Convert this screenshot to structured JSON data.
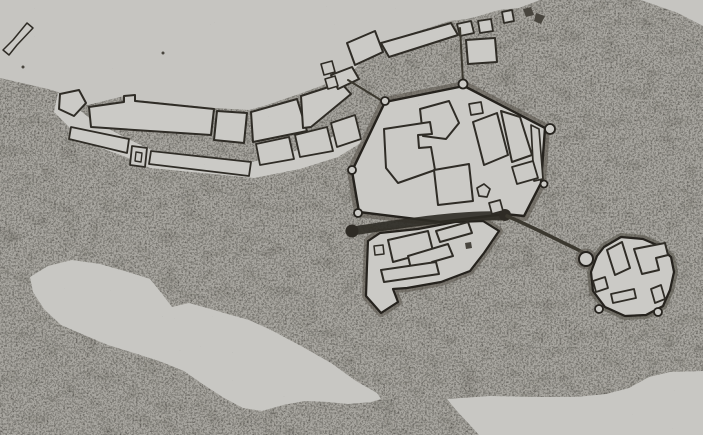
{
  "canvas": {
    "width": 703,
    "height": 435
  },
  "palette": {
    "water": "#c6c5c1",
    "lake": "#c8c7c3",
    "platform": "#cbcac6",
    "landBase": "#a7a59f",
    "ink": "#2e2b25",
    "inkSoft": "#48453e",
    "outline": "#2f2c26",
    "wall": "#25221d",
    "fringe": "#5b574f",
    "road": "#3b382f"
  },
  "map": {
    "layers": [
      {
        "shape": "rect",
        "name": "water-background",
        "x": 0,
        "y": 0,
        "w": 703,
        "h": 435,
        "fill": "water"
      },
      {
        "shape": "path",
        "name": "land-mass",
        "fill": "landBase",
        "filter": "stipple",
        "d": "M0,78 L48,89 58,92 88,105 124,96 136,100 214,108 249,110 264,106 302,93 334,81 354,70 363,60 381,43 450,21 467,19 479,16 499,10 519,8 540,0 L703,0 L703,435 L0,435 Z"
      },
      {
        "shape": "polygon",
        "name": "islet-a",
        "points": "523,9 531,7 534,15 526,17",
        "fill": "inkSoft"
      },
      {
        "shape": "polygon",
        "name": "islet-b",
        "points": "536,13 545,16 541,24 534,21",
        "fill": "inkSoft"
      },
      {
        "shape": "circle",
        "name": "water-dot-a",
        "cx": 163,
        "cy": 53,
        "r": 1.5,
        "fill": "inkSoft"
      },
      {
        "shape": "circle",
        "name": "water-dot-b",
        "cx": 23,
        "cy": 67,
        "r": 1.5,
        "fill": "inkSoft"
      },
      {
        "shape": "polygon",
        "name": "shore-wedge-top-right",
        "points": "641,0 703,0 703,26 678,13",
        "fill": "water"
      },
      {
        "shape": "polygon",
        "name": "lake-bottom-left",
        "fill": "lake",
        "points": "30,277 48,266 72,260 100,264 128,272 150,279 163,295 172,307 189,303 207,308 224,313 249,320 273,331 301,346 331,363 356,381 377,393 381,399 371,402 348,404 328,402 305,401 283,405 262,411 243,408 224,398 204,385 184,371 159,361 134,353 108,345 84,335 61,325 44,309 33,292"
      },
      {
        "shape": "polygon",
        "name": "river-band-bottom-right",
        "fill": "lake",
        "points": "447,399 490,396 540,397 576,397 606,394 629,388 649,377 670,372 703,371 703,435 479,435 470,425 456,410"
      },
      {
        "shape": "path",
        "name": "jetty-top-left",
        "d": "M3,50 L9,55 L17,45 L33,28 L27,23 L13,40 Z",
        "fill": "platform",
        "stroke": "outline",
        "sw": 1.5
      },
      {
        "shape": "polygon",
        "name": "shore-platform",
        "fill": "platform",
        "points": "58,93 92,120 130,140 152,150 252,162 295,151 330,138 356,126 364,141 338,157 300,169 254,178 150,168 126,157 84,142 54,112"
      },
      {
        "shape": "polygon",
        "name": "shore-block-a",
        "points": "60,94 79,90 86,103 74,116 59,109",
        "fill": "platform",
        "stroke": "outline",
        "sw": 2
      },
      {
        "shape": "polygon",
        "name": "shore-block-b",
        "points": "89,107 124,102 124,96 135,95 135,101 214,109 211,135 150,131 91,127",
        "fill": "platform",
        "stroke": "outline",
        "sw": 2
      },
      {
        "shape": "polygon",
        "name": "shore-block-c",
        "points": "217,111 247,113 244,143 214,140",
        "fill": "platform",
        "stroke": "outline",
        "sw": 2
      },
      {
        "shape": "polygon",
        "name": "shore-block-d",
        "points": "251,112 297,99 307,131 253,142",
        "fill": "platform",
        "stroke": "outline",
        "sw": 2
      },
      {
        "shape": "polygon",
        "name": "shore-block-e",
        "points": "301,96 341,83 351,94 311,127 303,128",
        "fill": "platform",
        "stroke": "outline",
        "sw": 2
      },
      {
        "shape": "polygon",
        "name": "shore-block-f",
        "points": "331,75 352,67 359,79 338,89",
        "fill": "platform",
        "stroke": "outline",
        "sw": 2
      },
      {
        "shape": "polygon",
        "name": "shore-strip-g",
        "points": "71,127 129,139 127,153 69,139",
        "fill": "platform",
        "stroke": "outline",
        "sw": 1.8
      },
      {
        "shape": "polygon",
        "name": "shore-strip-h",
        "points": "132,146 147,148 145,167 130,165",
        "fill": "platform",
        "stroke": "outline",
        "sw": 1.8
      },
      {
        "shape": "polygon",
        "name": "shore-strip-h-inner",
        "points": "136,152 142,153 141,162 135,161",
        "fill": "platform",
        "stroke": "outline",
        "sw": 1.4
      },
      {
        "shape": "polygon",
        "name": "shore-strip-i",
        "points": "151,151 251,162 249,176 149,164",
        "fill": "platform",
        "stroke": "outline",
        "sw": 1.8
      },
      {
        "shape": "polygon",
        "name": "shore-strip-j",
        "points": "256,144 289,137 294,159 260,165",
        "fill": "platform",
        "stroke": "outline",
        "sw": 1.8
      },
      {
        "shape": "polygon",
        "name": "shore-strip-k",
        "points": "295,135 327,127 333,151 300,157",
        "fill": "platform",
        "stroke": "outline",
        "sw": 1.8
      },
      {
        "shape": "polygon",
        "name": "shore-strip-l",
        "points": "331,123 355,115 361,139 337,147",
        "fill": "platform",
        "stroke": "outline",
        "sw": 1.8
      },
      {
        "shape": "polygon",
        "name": "shore-square-m",
        "points": "321,64 332,61 335,72 324,75",
        "fill": "platform",
        "stroke": "outline",
        "sw": 1.6
      },
      {
        "shape": "polygon",
        "name": "shore-square-m2",
        "points": "325,79 335,76 338,86 328,89",
        "fill": "platform",
        "stroke": "outline",
        "sw": 1.6
      },
      {
        "shape": "polygon",
        "name": "north-block-long",
        "points": "381,43 451,23 458,35 389,57",
        "fill": "platform",
        "stroke": "outline",
        "sw": 2
      },
      {
        "shape": "polygon",
        "name": "north-block-o",
        "points": "347,43 375,31 383,52 355,65",
        "fill": "platform",
        "stroke": "outline",
        "sw": 2
      },
      {
        "shape": "polygon",
        "name": "north-square-p",
        "points": "457,24 471,21 474,33 460,36",
        "fill": "platform",
        "stroke": "outline",
        "sw": 1.8
      },
      {
        "shape": "polygon",
        "name": "north-square-q",
        "points": "478,21 491,19 493,31 480,33",
        "fill": "platform",
        "stroke": "outline",
        "sw": 1.8
      },
      {
        "shape": "polygon",
        "name": "north-square-r",
        "points": "502,12 512,10 514,21 504,23",
        "fill": "platform",
        "stroke": "outline",
        "sw": 1.8
      },
      {
        "shape": "polygon",
        "name": "north-square-s",
        "points": "466,40 495,38 497,62 468,64",
        "fill": "platform",
        "stroke": "outline",
        "sw": 2
      },
      {
        "shape": "path",
        "name": "road-north-gate",
        "d": "M460,28 L463,82",
        "fill": "none",
        "stroke": "road",
        "sw": 2
      },
      {
        "shape": "path",
        "name": "road-west-gate",
        "d": "M348,80 L384,102",
        "fill": "none",
        "stroke": "road",
        "sw": 2
      },
      {
        "shape": "polygon",
        "name": "town-glacis-fringe",
        "fill": "none",
        "stroke": "fringe",
        "sw": 10,
        "op": 0.6,
        "points": "385,102 464,86 545,128 541,183 524,216 505,214 440,222 359,212 352,171"
      },
      {
        "shape": "polygon",
        "name": "annex-glacis-fringe",
        "fill": "none",
        "stroke": "fringe",
        "sw": 8,
        "op": 0.6,
        "points": "368,241 380,233 418,229 455,222 483,221 499,231 484,253 470,271 441,282 407,288 393,289 398,302 381,313 366,296 367,266"
      },
      {
        "shape": "polygon",
        "name": "town-platform",
        "fill": "platform",
        "stroke": "wall",
        "sw": 2.4,
        "points": "385,102 464,86 545,128 541,183 524,216 505,214 440,222 359,212 352,171"
      },
      {
        "shape": "polygon",
        "name": "annex-platform",
        "fill": "platform",
        "stroke": "wall",
        "sw": 2.2,
        "points": "368,241 380,233 418,229 455,222 483,221 499,231 484,253 470,271 441,282 407,288 393,289 398,302 381,313 366,296 367,266"
      },
      {
        "shape": "path",
        "name": "moat-channel",
        "d": "M352,231 C400,224 460,214 503,216",
        "fill": "none",
        "stroke": "ink",
        "sw": 9,
        "op": 0.9
      },
      {
        "shape": "circle",
        "name": "channel-gate-west",
        "cx": 352,
        "cy": 231,
        "r": 6.5,
        "fill": "ink"
      },
      {
        "shape": "circle",
        "name": "channel-gate-east",
        "cx": 505,
        "cy": 215,
        "r": 6,
        "fill": "ink"
      },
      {
        "shape": "polygon",
        "name": "town-block-pentagon",
        "points": "420,109 449,101 459,123 446,139 423,136",
        "fill": "platform",
        "stroke": "outline",
        "sw": 2
      },
      {
        "shape": "polygon",
        "name": "town-block-small-square",
        "points": "469,104 481,102 483,113 471,115",
        "fill": "platform",
        "stroke": "outline",
        "sw": 1.7
      },
      {
        "shape": "polygon",
        "name": "town-block-west-irregular",
        "points": "384,129 430,122 432,134 418,135 419,148 431,147 435,170 398,183 386,168",
        "fill": "platform",
        "stroke": "outline",
        "sw": 2
      },
      {
        "shape": "polygon",
        "name": "town-block-east-bar1",
        "points": "473,122 497,113 508,155 484,165",
        "fill": "platform",
        "stroke": "outline",
        "sw": 2
      },
      {
        "shape": "polygon",
        "name": "town-block-east-bar2",
        "points": "501,111 520,117 532,155 512,162",
        "fill": "platform",
        "stroke": "outline",
        "sw": 2
      },
      {
        "shape": "polygon",
        "name": "town-block-east-thin",
        "points": "531,125 539,129 543,179 534,181",
        "fill": "platform",
        "stroke": "outline",
        "sw": 1.7
      },
      {
        "shape": "polygon",
        "name": "town-block-east-low",
        "points": "512,167 533,161 538,178 517,184",
        "fill": "platform",
        "stroke": "outline",
        "sw": 1.8
      },
      {
        "shape": "polygon",
        "name": "town-block-south-trapezoid",
        "points": "434,170 469,164 473,201 438,205",
        "fill": "platform",
        "stroke": "outline",
        "sw": 2
      },
      {
        "shape": "polygon",
        "name": "town-block-blob",
        "points": "477,188 484,184 490,189 487,197 479,196",
        "fill": "platform",
        "stroke": "outline",
        "sw": 1.7
      },
      {
        "shape": "polygon",
        "name": "town-block-gate-rect",
        "points": "489,203 500,200 503,211 492,214",
        "fill": "platform",
        "stroke": "outline",
        "sw": 1.7
      },
      {
        "shape": "polygon",
        "name": "annex-building-big-rect",
        "points": "388,240 428,231 433,251 393,262",
        "fill": "platform",
        "stroke": "outline",
        "sw": 2
      },
      {
        "shape": "polygon",
        "name": "annex-building-slant-bar",
        "points": "436,231 468,222 472,233 440,242",
        "fill": "platform",
        "stroke": "outline",
        "sw": 2
      },
      {
        "shape": "polygon",
        "name": "annex-building-l-shape",
        "points": "408,256 448,244 453,256 432,262 433,269 411,269",
        "fill": "platform",
        "stroke": "outline",
        "sw": 2
      },
      {
        "shape": "polygon",
        "name": "annex-building-long-bar",
        "points": "381,270 436,262 439,274 384,282",
        "fill": "platform",
        "stroke": "outline",
        "sw": 2
      },
      {
        "shape": "polygon",
        "name": "annex-building-small-square",
        "points": "374,246 383,245 384,254 375,255",
        "fill": "platform",
        "stroke": "outline",
        "sw": 1.5
      },
      {
        "shape": "polygon",
        "name": "annex-building-dot",
        "points": "465,243 471,242 472,248 466,249",
        "fill": "inkSoft"
      },
      {
        "shape": "circle",
        "name": "bastion-north",
        "cx": 463,
        "cy": 84,
        "r": 4.5,
        "fill": "platform",
        "stroke": "wall",
        "sw": 1.8
      },
      {
        "shape": "circle",
        "name": "bastion-northwest",
        "cx": 385,
        "cy": 101,
        "r": 4,
        "fill": "platform",
        "stroke": "wall",
        "sw": 1.8
      },
      {
        "shape": "circle",
        "name": "bastion-east",
        "cx": 550,
        "cy": 129,
        "r": 5,
        "fill": "platform",
        "stroke": "wall",
        "sw": 1.8
      },
      {
        "shape": "circle",
        "name": "bastion-west",
        "cx": 352,
        "cy": 170,
        "r": 4,
        "fill": "platform",
        "stroke": "wall",
        "sw": 1.8
      },
      {
        "shape": "circle",
        "name": "bastion-southwest",
        "cx": 358,
        "cy": 213,
        "r": 4,
        "fill": "platform",
        "stroke": "wall",
        "sw": 1.8
      },
      {
        "shape": "circle",
        "name": "bastion-southeast",
        "cx": 544,
        "cy": 184,
        "r": 3.5,
        "fill": "platform",
        "stroke": "wall",
        "sw": 1.8
      },
      {
        "shape": "path",
        "name": "causeway-to-fort",
        "d": "M507,216 C530,226 548,235 566,244 C575,248 580,251 586,254",
        "fill": "none",
        "stroke": "road",
        "sw": 3.5
      },
      {
        "shape": "polygon",
        "name": "fort-glacis-fringe",
        "fill": "none",
        "stroke": "fringe",
        "sw": 8,
        "op": 0.65,
        "points": "597,256 604,247 621,237 643,239 657,245 671,257 674,272 670,290 663,306 646,315 625,316 605,307 593,291 591,272"
      },
      {
        "shape": "circle",
        "name": "fort-knob-fringe",
        "cx": 586,
        "cy": 259,
        "r": 8,
        "fill": "none",
        "stroke": "fringe",
        "sw": 5,
        "op": 0.6
      },
      {
        "shape": "circle",
        "name": "fort-knob-tower",
        "cx": 586,
        "cy": 259,
        "r": 7,
        "fill": "platform",
        "stroke": "wall",
        "sw": 2
      },
      {
        "shape": "polygon",
        "name": "fort-platform",
        "fill": "platform",
        "stroke": "wall",
        "sw": 2.2,
        "points": "597,256 604,247 621,237 643,239 657,245 671,257 674,272 670,290 663,306 646,315 625,316 605,307 593,291 591,272"
      },
      {
        "shape": "circle",
        "name": "fort-bump-south-a",
        "cx": 599,
        "cy": 309,
        "r": 4,
        "fill": "platform",
        "stroke": "wall",
        "sw": 1.8
      },
      {
        "shape": "circle",
        "name": "fort-bump-south-b",
        "cx": 658,
        "cy": 312,
        "r": 4,
        "fill": "platform",
        "stroke": "wall",
        "sw": 1.8
      },
      {
        "shape": "polygon",
        "name": "fort-building-slant-rect",
        "points": "607,250 622,242 630,268 615,275",
        "fill": "platform",
        "stroke": "outline",
        "sw": 2
      },
      {
        "shape": "polygon",
        "name": "fort-building-l-shape",
        "points": "634,249 665,243 668,255 656,258 659,270 642,274",
        "fill": "platform",
        "stroke": "outline",
        "sw": 2
      },
      {
        "shape": "polygon",
        "name": "fort-building-bar-sw",
        "points": "593,281 605,277 608,288 596,292",
        "fill": "platform",
        "stroke": "outline",
        "sw": 1.8
      },
      {
        "shape": "polygon",
        "name": "fort-building-bar-s",
        "points": "611,294 634,289 636,298 613,303",
        "fill": "platform",
        "stroke": "outline",
        "sw": 1.8
      },
      {
        "shape": "polygon",
        "name": "fort-building-bar-se",
        "points": "651,289 661,285 665,299 655,303",
        "fill": "platform",
        "stroke": "outline",
        "sw": 1.8
      },
      {
        "shape": "rect",
        "name": "paper-grain-overlay",
        "x": 0,
        "y": 0,
        "w": 703,
        "h": 435,
        "fill": "#000000",
        "filter": "grain",
        "op": 0.12
      }
    ]
  }
}
